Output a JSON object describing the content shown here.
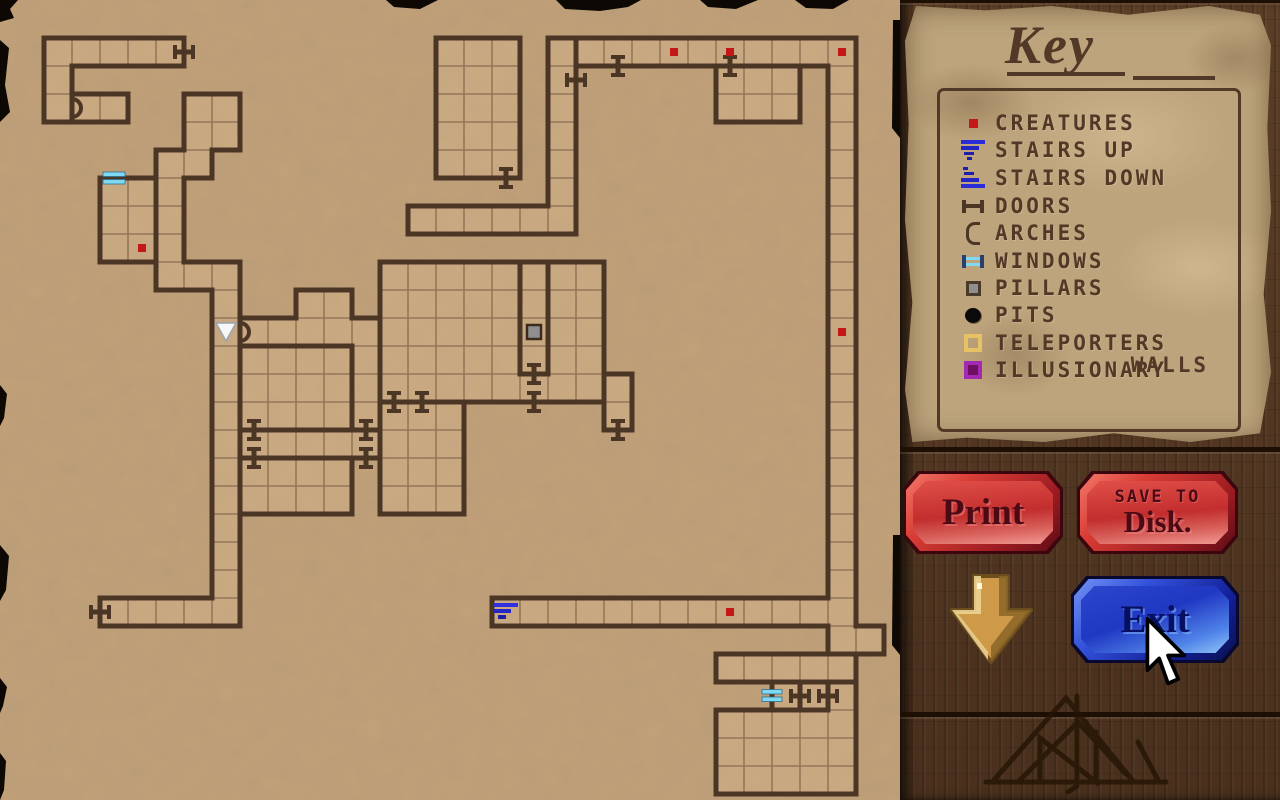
{
  "colors": {
    "wood": "#4e3420",
    "parchment": "#c2a179",
    "ink": "#523826",
    "wall": "#4b3626",
    "grid": "#8a6f52",
    "floor": "#d8b78e",
    "creature": "#c41818",
    "stairs": "#2b2bd8",
    "window": "#7fd9f2",
    "pillar": "#8f8f8f",
    "teleporter": "#e6c264",
    "illusion": "#a328b4",
    "redbtn": "#c23030",
    "bluebtn": "#2745d2",
    "gold": "#cda04f"
  },
  "key_panel": {
    "title": "Key",
    "items": [
      {
        "icon": "creature-icon",
        "label": "CREATURES"
      },
      {
        "icon": "stairs-up-icon",
        "label": "STAIRS UP"
      },
      {
        "icon": "stairs-down-icon",
        "label": "STAIRS DOWN"
      },
      {
        "icon": "door-icon",
        "label": "DOORS"
      },
      {
        "icon": "arch-icon",
        "label": "ARCHES"
      },
      {
        "icon": "window-icon",
        "label": "WINDOWS"
      },
      {
        "icon": "pillar-icon",
        "label": "PILLARS"
      },
      {
        "icon": "pit-icon",
        "label": "PITS"
      },
      {
        "icon": "teleporter-icon",
        "label": "TELEPORTERS"
      },
      {
        "icon": "illusionary-wall-icon",
        "label": "ILLUSIONARY",
        "label2": "WALLS"
      }
    ]
  },
  "buttons": {
    "print": {
      "label": "Print"
    },
    "save": {
      "line1": "SAVE TO",
      "line2": "Disk."
    },
    "exit": {
      "label": "Exit"
    }
  },
  "map": {
    "grid": {
      "ox": 44,
      "oy": 38,
      "cell": 28,
      "cols": 30,
      "rows": 27
    },
    "areas": [
      {
        "name": "northwest-rooms",
        "rects": [
          [
            0,
            0,
            4,
            0
          ],
          [
            0,
            1,
            0,
            2
          ]
        ]
      },
      {
        "name": "northwest-annex",
        "rects": [
          [
            1,
            2,
            2,
            2
          ]
        ]
      },
      {
        "name": "west-snake-corridor",
        "rects": [
          [
            5,
            2,
            6,
            3
          ],
          [
            4,
            4,
            5,
            4
          ],
          [
            4,
            5,
            4,
            7
          ],
          [
            4,
            8,
            6,
            8
          ],
          [
            6,
            9,
            6,
            20
          ],
          [
            2,
            20,
            5,
            20
          ]
        ]
      },
      {
        "name": "northwest-block",
        "rects": [
          [
            2,
            5,
            3,
            7
          ]
        ]
      },
      {
        "name": "mid-band",
        "rects": [
          [
            9,
            9,
            10,
            9
          ],
          [
            7,
            10,
            11,
            10
          ],
          [
            11,
            11,
            11,
            13
          ]
        ]
      },
      {
        "name": "centerleft-room-top",
        "rects": [
          [
            7,
            11,
            10,
            13
          ]
        ]
      },
      {
        "name": "centerleft-band",
        "rects": [
          [
            7,
            14,
            11,
            14
          ]
        ]
      },
      {
        "name": "centerleft-room-bottom",
        "rects": [
          [
            7,
            15,
            10,
            16
          ]
        ]
      },
      {
        "name": "great-hall",
        "rects": [
          [
            12,
            8,
            16,
            12
          ],
          [
            18,
            8,
            19,
            12
          ],
          [
            17,
            12,
            17,
            12
          ]
        ]
      },
      {
        "name": "pillar-column",
        "rects": [
          [
            17,
            8,
            17,
            11
          ]
        ]
      },
      {
        "name": "middle-room",
        "rects": [
          [
            12,
            13,
            14,
            16
          ]
        ]
      },
      {
        "name": "east-annex",
        "rects": [
          [
            20,
            12,
            20,
            13
          ]
        ]
      },
      {
        "name": "north-room",
        "rects": [
          [
            14,
            0,
            16,
            4
          ]
        ]
      },
      {
        "name": "north-corridor",
        "rects": [
          [
            18,
            0,
            18,
            5
          ],
          [
            13,
            6,
            18,
            6
          ]
        ]
      },
      {
        "name": "perimeter-corridor",
        "rects": [
          [
            19,
            0,
            28,
            0
          ],
          [
            28,
            1,
            28,
            20
          ],
          [
            16,
            20,
            27,
            20
          ],
          [
            28,
            21,
            29,
            21
          ]
        ]
      },
      {
        "name": "northeast-room",
        "rects": [
          [
            24,
            1,
            26,
            2
          ]
        ]
      },
      {
        "name": "southeast-room-top",
        "rects": [
          [
            24,
            22,
            28,
            22
          ]
        ]
      },
      {
        "name": "southeast-box",
        "rects": [
          [
            26,
            23,
            26,
            23
          ]
        ]
      },
      {
        "name": "southeast-cell",
        "rects": [
          [
            27,
            23,
            27,
            23
          ]
        ]
      },
      {
        "name": "southeast-room",
        "rects": [
          [
            24,
            24,
            28,
            26
          ],
          [
            28,
            23,
            28,
            23
          ]
        ]
      }
    ],
    "icons": {
      "creatures": [
        [
          3,
          7
        ],
        [
          22,
          0
        ],
        [
          24,
          0
        ],
        [
          28,
          0
        ],
        [
          28,
          10
        ],
        [
          24,
          20
        ]
      ],
      "doors": [
        {
          "c": 4,
          "r": 0,
          "side": "E"
        },
        {
          "c": 16,
          "r": 4,
          "side": "S"
        },
        {
          "c": 18,
          "r": 1,
          "side": "E"
        },
        {
          "c": 20,
          "r": 0,
          "side": "S"
        },
        {
          "c": 24,
          "r": 0,
          "side": "S"
        },
        {
          "c": 17,
          "r": 11,
          "side": "S"
        },
        {
          "c": 17,
          "r": 12,
          "side": "S"
        },
        {
          "c": 12,
          "r": 12,
          "side": "S"
        },
        {
          "c": 13,
          "r": 12,
          "side": "S"
        },
        {
          "c": 20,
          "r": 13,
          "side": "S"
        },
        {
          "c": 11,
          "r": 13,
          "side": "S"
        },
        {
          "c": 11,
          "r": 14,
          "side": "S"
        },
        {
          "c": 7,
          "r": 14,
          "side": "N"
        },
        {
          "c": 7,
          "r": 15,
          "side": "N"
        },
        {
          "c": 2,
          "r": 20,
          "side": "W"
        },
        {
          "c": 26,
          "r": 23,
          "side": "E"
        },
        {
          "c": 27,
          "r": 23,
          "side": "E"
        }
      ],
      "arches": [
        {
          "c": 1,
          "r": 2,
          "side": "W"
        },
        {
          "c": 7,
          "r": 10,
          "side": "W"
        }
      ],
      "windows": [
        {
          "c": 2,
          "r": 5,
          "side": "N"
        },
        {
          "c": 26,
          "r": 23,
          "side": "W"
        }
      ],
      "stairs": [
        {
          "c": 16,
          "r": 20,
          "dir": "up"
        }
      ],
      "pillars": [
        [
          17,
          10
        ]
      ],
      "party_marker": [
        6,
        10
      ]
    }
  }
}
